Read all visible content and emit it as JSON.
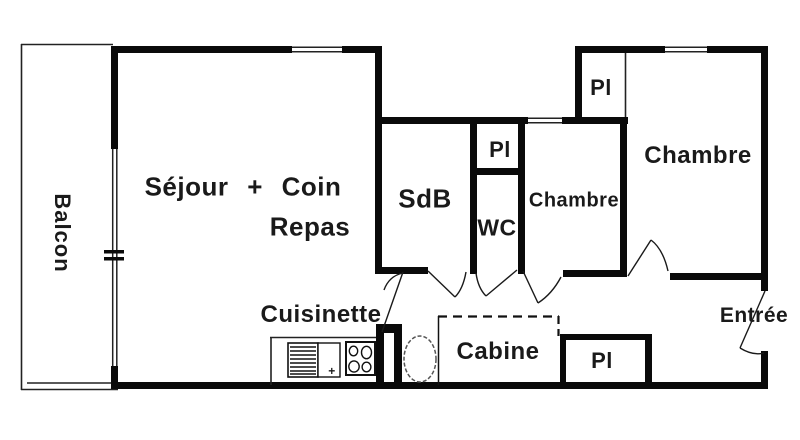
{
  "title": "Floor plan of a studio apartment with cabin and two bedrooms",
  "colors": {
    "background": "#ffffff",
    "wall": "#0a0a0a",
    "thin_line": "#222222",
    "fixture_line": "#555555"
  },
  "rooms": {
    "balcony": {
      "label": "Balcon"
    },
    "living": {
      "line1": "Séjour + Coin",
      "line2": "Repas"
    },
    "kitchenette": {
      "label": "Cuisinette",
      "plus": "+"
    },
    "bathroom": {
      "label": "SdB"
    },
    "toilet": {
      "label": "WC"
    },
    "closet_hall": {
      "label": "Pl"
    },
    "bedroom_middle": {
      "label": "Chambre"
    },
    "closet_top": {
      "label": "Pl"
    },
    "bedroom_right": {
      "label": "Chambre"
    },
    "cabin": {
      "label": "Cabine"
    },
    "closet_entry": {
      "label": "Pl"
    },
    "entrance": {
      "label": "Entrée"
    }
  },
  "icons": {
    "fridge": "fridge-icon",
    "cooktop": "cooktop-icon",
    "oval_fixture": "oval-fixture-icon",
    "window_break": "window-break-icon",
    "door_swings": "door-swing"
  }
}
